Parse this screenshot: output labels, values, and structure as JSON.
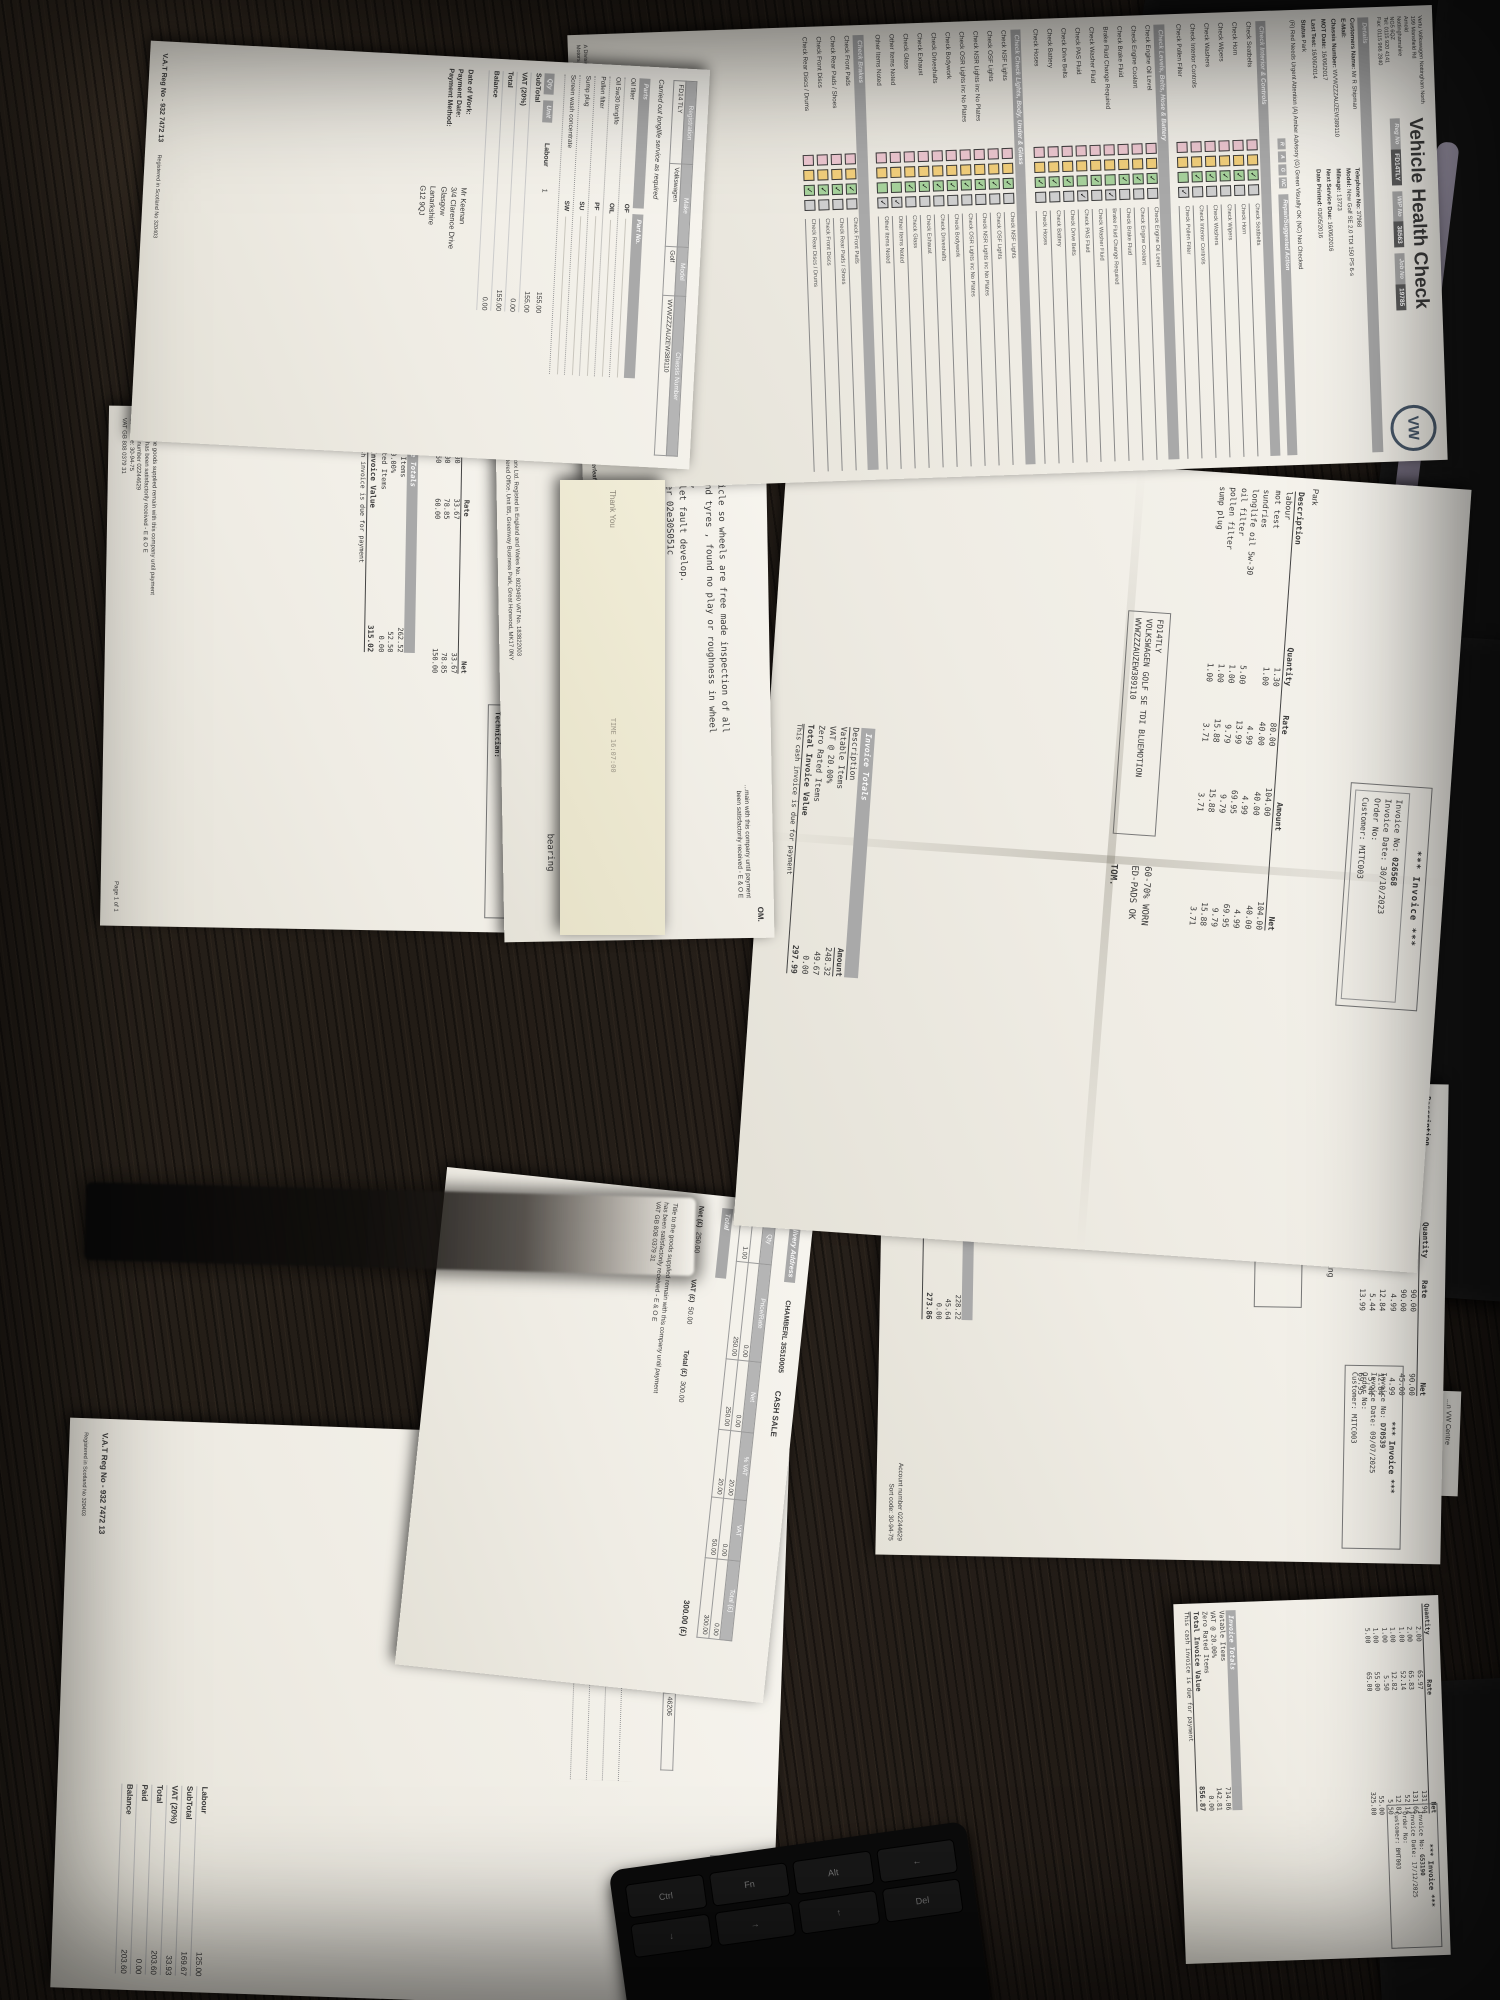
{
  "vhc": {
    "title": "Vehicle Health Check",
    "dealer_lines": [
      "Vertu Volkswagen Nottingham North",
      "199 Mansfield Rd",
      "Arnold",
      "Nottinghamshire",
      "NG5 6QZ",
      "Tel: 0115 920 4141",
      "Fax: 0115 966 2840"
    ],
    "logo_text": "VW",
    "badges": [
      {
        "label": "Reg No",
        "value": "FD14TLY"
      },
      {
        "label": "WIP No",
        "value": "38563"
      },
      {
        "label": "Job No",
        "value": "19785"
      }
    ],
    "details_band": "Details",
    "details": [
      {
        "label": "Customers Name:",
        "value": "Mr R Shipman"
      },
      {
        "label": "Telephone No:",
        "value": "37968"
      },
      {
        "label": "E-Mail:",
        "value": ""
      },
      {
        "label": "Model:",
        "value": "New Golf SE 2.0 TDI 150 PS 6-s"
      },
      {
        "label": "Chassis Number:",
        "value": "WVWZZZAUZEW389110"
      },
      {
        "label": "Mileage:",
        "value": "13723"
      },
      {
        "label": "MOT Date:",
        "value": "16/06/2017"
      },
      {
        "label": "Next Service Due:",
        "value": "16/06/2016"
      },
      {
        "label": "Last Test:",
        "value": "16/06/2014"
      },
      {
        "label": "Date Printed:",
        "value": "03/05/2016"
      },
      {
        "label": "Status",
        "value": "Park"
      }
    ],
    "key_legend": "(R) Red Needs Urgent Attention      (A) Amber Advisory      (G) Green Visually OK      (NC) Not Checked",
    "rag_headers": [
      "R",
      "A",
      "G",
      "NC"
    ],
    "action_header": "Repair/Suggested Action",
    "colors": {
      "r": "#edc7d0",
      "a": "#f2cf7b",
      "g": "#a7d29c",
      "nc": "#cfcfcf"
    },
    "sections": [
      {
        "title": "Check Interior & Controls",
        "items": [
          {
            "label": "Check Seatbelts",
            "state": "G"
          },
          {
            "label": "Check Horn",
            "state": "G"
          },
          {
            "label": "Check Wipers",
            "state": "G"
          },
          {
            "label": "Check Washers",
            "state": "G"
          },
          {
            "label": "Check Interior Controls",
            "state": "G"
          },
          {
            "label": "Check Pollen Filter",
            "state": "NC"
          }
        ]
      },
      {
        "title": "Check Levels, Belts, Hose & Battery",
        "items": [
          {
            "label": "Check Engine Oil Level",
            "state": "G"
          },
          {
            "label": "Check Engine Coolant",
            "state": "G"
          },
          {
            "label": "Check Brake Fluid",
            "state": "G"
          },
          {
            "label": "Brake Fluid Change Required",
            "state": "NC"
          },
          {
            "label": "Check Washer Fluid",
            "state": "G"
          },
          {
            "label": "Check PAS Fluid",
            "state": "NC"
          },
          {
            "label": "Check Drive Belts",
            "state": "G"
          },
          {
            "label": "Check Battery",
            "state": "G"
          },
          {
            "label": "Check Hoses",
            "state": "G"
          }
        ]
      },
      {
        "title": "Check Check Lights, Body, Under & Glass",
        "items": [
          {
            "label": "Check NSF Lights",
            "state": "G"
          },
          {
            "label": "Check OSF Lights",
            "state": "G"
          },
          {
            "label": "Check NSR Lights inc No Plates",
            "state": "G"
          },
          {
            "label": "Check OSR Lights inc No Plates",
            "state": "G"
          },
          {
            "label": "Check Bodywork",
            "state": "G"
          },
          {
            "label": "Check Driveshafts",
            "state": "G"
          },
          {
            "label": "Check Exhaust",
            "state": "G"
          },
          {
            "label": "Check Glass",
            "state": "G"
          },
          {
            "label": "Other Items Noted",
            "state": "NC"
          },
          {
            "label": "Other Items Noted",
            "state": "NC"
          }
        ]
      },
      {
        "title": "Check Brakes",
        "items": [
          {
            "label": "Check Front Pads",
            "state": "G"
          },
          {
            "label": "Check Rear Pads / Shoes",
            "state": "G"
          },
          {
            "label": "Check Front Discs",
            "state": "G"
          },
          {
            "label": "Check Rear Discs / Drums",
            "state": "G"
          }
        ]
      }
    ],
    "footer": "A Division of Bristol Street Fourth Investments Limited. Registered in England and Wales No 522056. Registered Office: Bristol Street, c/o VERTU Motors plc, Vertu House, Fifth Avenue Business Park, Team Valley, Gateshead, NE11 0XA. VAT No. 902 7372 38",
    "continued": "Continued Overleaf"
  },
  "p2": {
    "headers": [
      "Registration",
      "Make",
      "Model",
      "Chassis Number"
    ],
    "values": [
      "FD14 TLY",
      "Volkswagen",
      "Golf",
      "WVWZZZAUZEW389110"
    ],
    "work_line": "Carried out longlife service as required",
    "parts_header": "Parts",
    "partno_header": "Part No.",
    "qty_header": "Qty",
    "unit_header": "Unit",
    "parts": [
      {
        "name": "Oil filter",
        "code": "OF"
      },
      {
        "name": "Oil 5w30 longlife",
        "code": "OIL"
      },
      {
        "name": "Pollen filter",
        "code": "PF"
      },
      {
        "name": "Sump plug",
        "code": "SU"
      },
      {
        "name": "Screen wash concentrate",
        "code": "SW"
      }
    ],
    "labour": {
      "label": "Labour",
      "qty": "1",
      "unit": "155.00"
    },
    "totals": [
      {
        "label": "SubTotal",
        "value": "155.00"
      },
      {
        "label": "VAT (20%)",
        "value": "0.00"
      },
      {
        "label": "Total",
        "value": "155.00"
      },
      {
        "label": "Balance",
        "value": "0.00"
      }
    ],
    "pay_fields": [
      "Date of Work:",
      "Payment Date:",
      "Payment Method:"
    ],
    "customer": [
      "Mr Keenan",
      "3/4 Clarence Drive",
      "Glasgow",
      "Lanarkshire",
      "G12 9QJ"
    ],
    "vat_strip": "V.A.T Reg No - 932 7472 13",
    "reg_strip": "Registered in Scotland No 320403"
  },
  "p3": {
    "veh_box": [
      {
        "label": "Vehicle:",
        "value": "FD14TLY"
      },
      {
        "label": "Make:",
        "value": "VOLKSWAGEN GOLF SE TDI BLUEMOTION"
      },
      {
        "label": "VIN:",
        "value": "WVWZZZAUZEW389110"
      },
      {
        "label": "Mileage:",
        "value": "89101"
      },
      {
        "label": "Technician:",
        "value": ""
      }
    ],
    "rows": [
      {
        "desc": "",
        "qty": "1.00",
        "rate": "33.67",
        "net": "33.67"
      },
      {
        "desc": "",
        "qty": "1.00",
        "rate": "78.85",
        "net": "78.85"
      },
      {
        "desc": "",
        "qty": "2.50",
        "rate": "60.00",
        "net": "150.00"
      }
    ],
    "totals": {
      "vatable": "262.52",
      "vat": "52.50",
      "zero": "0.00",
      "total": "315.02"
    },
    "footer_lines": [
      "Title to the goods supplied remain with this company until payment",
      "for them has been satisfactorily received - E & O E",
      "Account number 02244629",
      "Sort code: 30-94-75",
      "VAT GB 808 0379 31"
    ],
    "page": "Page 1 of 1"
  },
  "p4": {
    "om": "OM.",
    "note_lines": [
      "Lift vehicle so wheels are free made inspection of all",
      "wheels and tyres , found no play or roughness in wheel",
      "bearings,",
      "Surgest let fault develop.",
      "DSG filter  02e30S051c",
      "DSG/DCT 5ltr g 052182a",
      "Labour"
    ],
    "bearing": "bearing",
    "remain_lines": [
      "...main with this company until payment",
      "been satisfactorily received - E & O E"
    ],
    "footer_lines": [
      "VagWorx Ltd. Registed in England and Wales No. 8029490 VAT No. 183822003",
      "Registered Office. Unit B5, Greenway Business Park, Great Horwood, MK17 0NY"
    ]
  },
  "receipt": {
    "thanks": "Thank You",
    "time": "TIME 16:07:00"
  },
  "inv": {
    "header": "*** Invoice ***",
    "f_no": "Invoice No:",
    "f_date": "Invoice Date:",
    "f_order": "Order No:",
    "f_cust": "Customer:",
    "col_desc": "Description",
    "col_qty": "Quantity",
    "col_rate": "Rate",
    "col_amount": "Amount",
    "col_net": "Net",
    "totals_title": "Invoice Totals",
    "vatable_label": "Vatable Items",
    "vat_label": "VAT @ 20.00%",
    "zero_label": "Zero Rated Items",
    "total_label": "Total Invoice Value",
    "due_note": "This cash invoice is due for payment"
  },
  "inv_a": {
    "no": "026568",
    "date": "30/10/2023",
    "order": "",
    "cust": "MITC003",
    "park": "Park",
    "veh_box": [
      "FD14TLY",
      "VOLKSWAGEN GOLF SE TDI BLUEMOTION",
      "WVWZZZAUZEW389110"
    ],
    "notes": [
      "60-70% WORN",
      "ED-PADS OK"
    ],
    "signature": "TOM.",
    "rows": [
      {
        "desc": "labour",
        "qty": "1.30",
        "rate": "80.00",
        "amount": "104.00",
        "net": "104.00"
      },
      {
        "desc": "mot test",
        "qty": "1.00",
        "rate": "40.00",
        "amount": "40.00",
        "net": "40.00"
      },
      {
        "desc": "sundries",
        "qty": "",
        "rate": "4.99",
        "amount": "4.99",
        "net": "4.99"
      },
      {
        "desc": "longlife oil 5w-30",
        "qty": "5.00",
        "rate": "13.99",
        "amount": "69.95",
        "net": "69.95"
      },
      {
        "desc": "oil filter",
        "qty": "1.00",
        "rate": "9.79",
        "amount": "9.79",
        "net": "9.79"
      },
      {
        "desc": "pollen filter",
        "qty": "1.00",
        "rate": "15.88",
        "amount": "15.88",
        "net": "15.88"
      },
      {
        "desc": "sump plug",
        "qty": "1.00",
        "rate": "3.71",
        "amount": "3.71",
        "net": "3.71"
      }
    ],
    "totals": {
      "vatable": "248.32",
      "vat": "49.67",
      "zero": "0.00",
      "total": "297.99"
    }
  },
  "inv_b": {
    "no": "D70539",
    "date": "09/07/2025",
    "order": "",
    "cust": "MITC003",
    "advise": [
      "Advise:",
      "vehicle- needs new front wheel bearing",
      "tread low"
    ],
    "veh_box": [
      "FD14TLY",
      "VOLKSWAGEN GOLF SE TDI BLUEMOTION",
      "WVWZZZAUZEW389110",
      "97877"
    ],
    "rows": [
      {
        "desc": "labour",
        "qty": "1.00",
        "rate": "90.00",
        "amount": "90.00",
        "net": "90.00"
      },
      {
        "desc": "labour",
        "qty": "0.50",
        "rate": "90.00",
        "amount": "45.00",
        "net": "45.00"
      },
      {
        "desc": "sundries",
        "qty": "",
        "rate": "4.99",
        "amount": "4.99",
        "net": "4.99"
      },
      {
        "desc": "oil filter",
        "qty": "1.00",
        "rate": "12.84",
        "amount": "12.84",
        "net": "12.84"
      },
      {
        "desc": "sump plug",
        "qty": "1.00",
        "rate": "5.44",
        "amount": "5.44",
        "net": "5.44"
      },
      {
        "desc": "longlife oil 5w-30",
        "qty": "5.00",
        "rate": "13.99",
        "amount": "69.95",
        "net": "69.95"
      }
    ],
    "totals": {
      "vatable": "228.22",
      "vat": "45.64",
      "zero": "0.00",
      "total": "273.86"
    },
    "account": "Account number 02244629",
    "sort": "Sort code: 30-94-75"
  },
  "inv_c": {
    "no": "G53190",
    "date": "17/12/2025",
    "order": "",
    "cust": "BMT003",
    "rows": [
      {
        "desc": "",
        "qty": "2.00",
        "rate": "65.97",
        "amount": "131.94",
        "net": "131.94"
      },
      {
        "desc": "",
        "qty": "2.00",
        "rate": "65.83",
        "amount": "131.66",
        "net": "131.66"
      },
      {
        "desc": "",
        "qty": "1.00",
        "rate": "52.14",
        "amount": "52.14",
        "net": "52.14"
      },
      {
        "desc": "",
        "qty": "1.00",
        "rate": "12.82",
        "amount": "12.82",
        "net": "12.82"
      },
      {
        "desc": "",
        "qty": "1.00",
        "rate": "5.50",
        "amount": "5.50",
        "net": "5.50"
      },
      {
        "desc": "",
        "qty": "1.00",
        "rate": "55.00",
        "amount": "55.00",
        "net": "55.00"
      },
      {
        "desc": "",
        "qty": "5.00",
        "rate": "65.00",
        "amount": "325.00",
        "net": "325.00"
      }
    ],
    "totals": {
      "vatable": "714.06",
      "vat": "142.81",
      "zero": "0.00",
      "total": "856.87"
    }
  },
  "cash": {
    "delivery_label": "Delivery Address",
    "account_line": "CHAMBERL 35510005",
    "sale_type": "CASH SALE",
    "headers": [
      "Qty",
      "Price/Rate",
      "Net",
      "% VAT",
      "VAT",
      "Total (£)"
    ],
    "rows": [
      [
        "",
        "0.00",
        "0.00",
        "20.00",
        "0.00",
        "0.00"
      ],
      [
        "1.00",
        "250.00",
        "250.00",
        "20.00",
        "50.00",
        "300.00"
      ]
    ],
    "total_label": "Total",
    "total_value": "300.00 (£)",
    "summary": [
      {
        "label": "Net (£)",
        "value": "250.00"
      },
      {
        "label": "VAT (£)",
        "value": "50.00"
      },
      {
        "label": "Total (£)",
        "value": "300.00"
      }
    ],
    "footer_lines": [
      "Title to the goods supplied remain with this company until payment",
      "has been satisfactorily received - E & O E",
      "VAT GB 808 0379 31"
    ]
  },
  "p10": {
    "title": "Invoice",
    "fields": [
      {
        "label": "Invoice No:",
        "value": "35146"
      },
      {
        "label": "Invoice Date:",
        "value": "27/10/2021"
      },
      {
        "label": "Order No:",
        "value": "K6E096"
      },
      {
        "label": "Date of Work:",
        "value": "27/10/2021"
      },
      {
        "label": "Payment Date:",
        "value": ""
      },
      {
        "label": "Payment Method:",
        "value": ""
      }
    ],
    "veh_headers": [
      "Make",
      "Model",
      "Chassis Number",
      "Mileage"
    ],
    "veh_values": [
      "Volkswagen",
      "Golf",
      "WVWZZZAUZEW389110",
      "46206"
    ],
    "work_line": "Carried out service as required.",
    "parts": [
      {
        "name": "Oil filter",
        "code": "OF"
      },
      {
        "name": "Oil 5w30 longlife",
        "code": "OIL"
      },
      {
        "name": "Sump plug",
        "code": "SU"
      },
      {
        "name": "Screen wash concentrate",
        "code": "SW"
      }
    ],
    "labour_qty": "1",
    "totals": [
      {
        "label": "Labour",
        "value": "125.00"
      },
      {
        "label": "SubTotal",
        "value": "169.67"
      },
      {
        "label": "VAT (20%)",
        "value": "33.93"
      },
      {
        "label": "Total",
        "value": "203.60"
      },
      {
        "label": "Paid",
        "value": "0.00"
      },
      {
        "label": "Balance",
        "value": "203.60"
      }
    ],
    "vat_strip": "V.A.T Reg No - 932 7472 13",
    "reg_strip": "Registered in Scotland No 320403"
  },
  "frag": {
    "line1": "...n VW Centre",
    "line2": "77015"
  },
  "keyboard": {
    "keys": [
      "Ctrl",
      "Fn",
      "Alt",
      "←",
      "↓",
      "→",
      "↑",
      "Del"
    ]
  }
}
